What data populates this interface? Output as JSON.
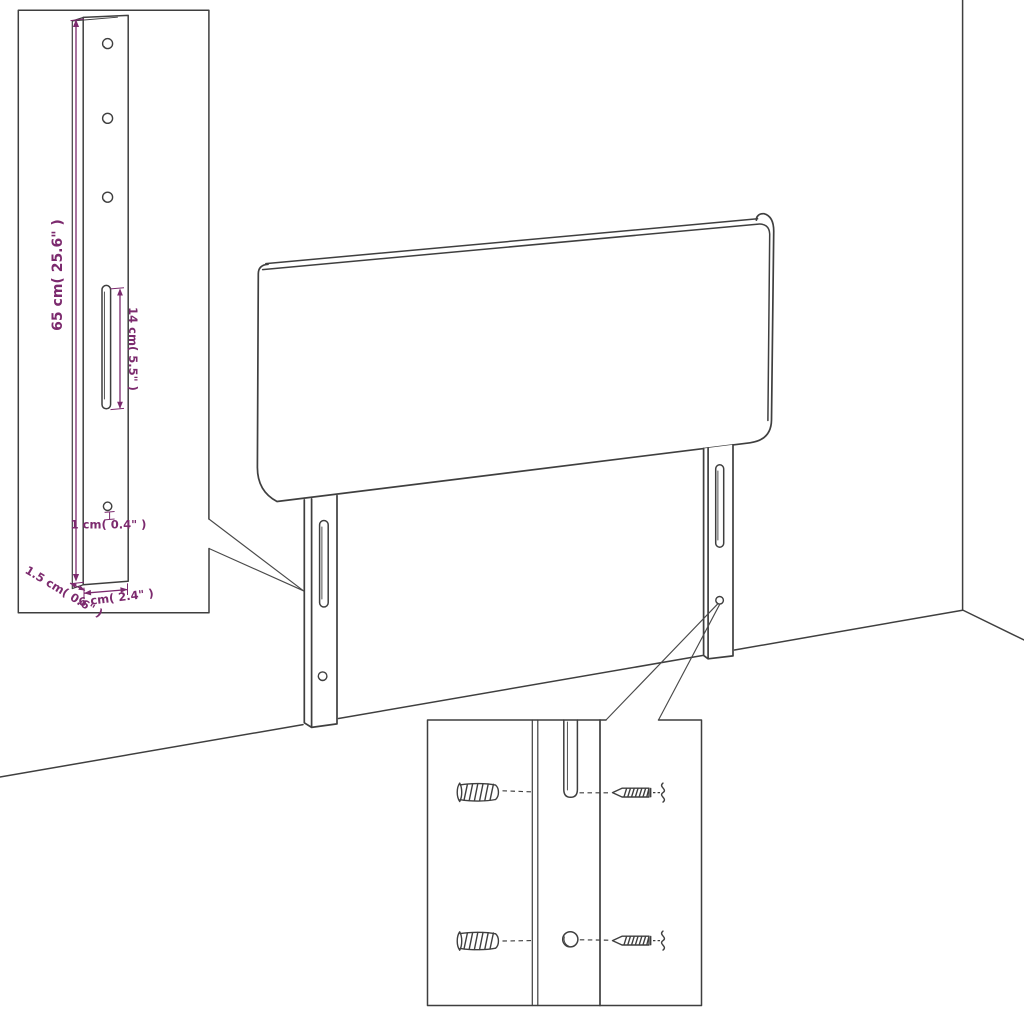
{
  "palette": {
    "line_color": "#3f3f3f",
    "dimension_color": "#7c2a6e",
    "background": "#ffffff"
  },
  "bracket_inset": {
    "labels": {
      "height": "65 cm( 25.6\" )",
      "slot_length": "14 cm( 5.5\" )",
      "hole_diameter": "1 cm( 0.4\" )",
      "thickness": "1.5 cm( 0.6\" )",
      "width": "6 cm( 2.4\" )"
    }
  },
  "hardware_inset": {
    "parts": [
      "wall-plug",
      "screw",
      "bracket-slot",
      "bracket-hole"
    ]
  },
  "scene": {
    "objects": [
      "headboard-panel",
      "left-mounting-bracket",
      "right-mounting-bracket",
      "wall-corner",
      "floor"
    ]
  }
}
